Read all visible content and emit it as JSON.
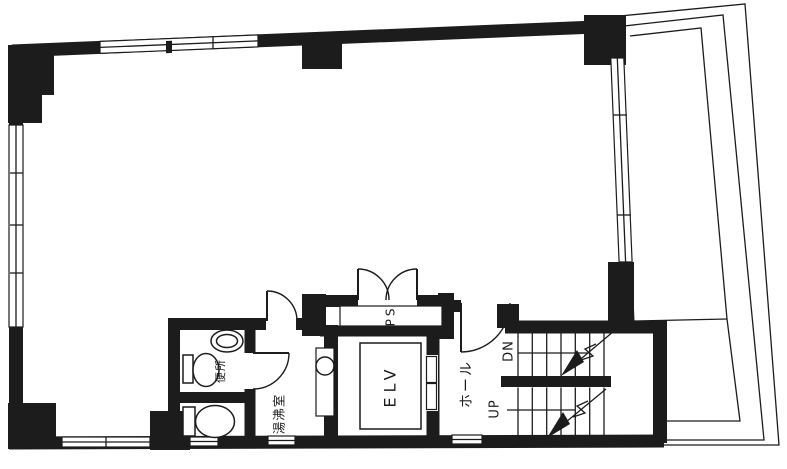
{
  "plan": {
    "labels": {
      "elevator": "ELV",
      "hall": "ホール",
      "pipe_shaft": "PS",
      "stairs_up": "UP",
      "stairs_down": "DN",
      "kitchenette": "湯沸室",
      "toilet": "便所"
    },
    "colors": {
      "wall": "#1c1c1c",
      "line": "#1c1c1c",
      "background": "#ffffff"
    }
  }
}
